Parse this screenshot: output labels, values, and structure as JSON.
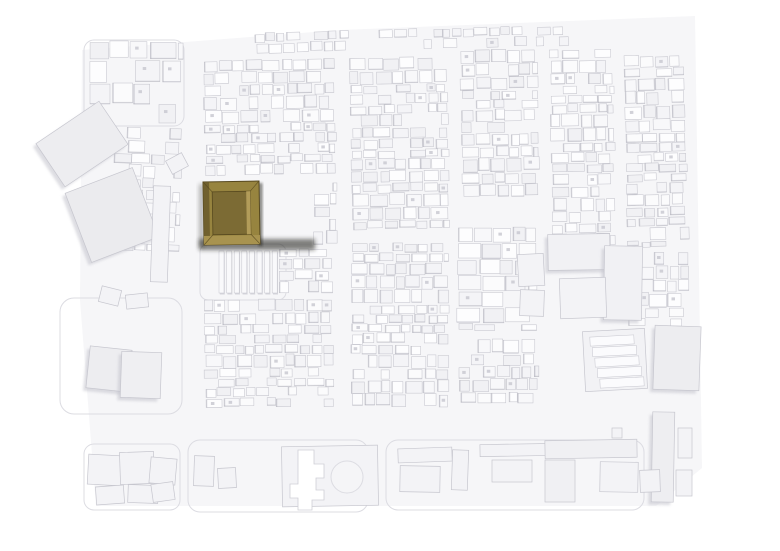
{
  "image": {
    "kind": "photograph of physical architectural massing model",
    "description": "Aerial view of a white urban site model; two brown wooden courtyard buildings are highlighted left of center, all other buildings are white."
  },
  "palette": {
    "bg": "#ffffff",
    "ground": "#f6f6f8",
    "shades": [
      "#fdfdfe",
      "#fbfbfc",
      "#f8f8fa",
      "#f4f4f7",
      "#f1f1f4"
    ],
    "cell_stroke": "#c6c6ce",
    "cell_shadow": "#b2b2bc",
    "hole": "#c9c9d1",
    "big_fill": "#f3f3f6",
    "big_shadow": "#c3c3cc",
    "outline": "#dcdce2",
    "wood_ring": "#97843f",
    "wood_ring_east": "#93803f",
    "wood_edge": "#57491f",
    "wood_left_wall": "#6b5c2c",
    "wood_bottom_band": "#a8934f",
    "wood_court_floor": "#7c6b34",
    "wood_inner_light": "#b29c59",
    "wood_cube": "#c8b171",
    "wood_cube_top": "#d5c182",
    "wood_cube_edge": "#9d874a",
    "court_white": "#d9d9db",
    "court_rim": "#3f361a",
    "opening_black": "#17140c",
    "drop_shadow": "#1f1d15"
  },
  "scene": {
    "ground": {
      "points": "82,50 340,30 695,16 702,468 656,506 96,506 80,300"
    },
    "outlines": [
      {
        "x": 60,
        "y": 298,
        "w": 122,
        "h": 116,
        "r": 14
      },
      {
        "x": 84,
        "y": 40,
        "w": 100,
        "h": 86,
        "r": 10
      },
      {
        "x": 188,
        "y": 440,
        "w": 180,
        "h": 72,
        "r": 12
      },
      {
        "x": 386,
        "y": 440,
        "w": 258,
        "h": 70,
        "r": 12
      },
      {
        "x": 84,
        "y": 444,
        "w": 96,
        "h": 66,
        "r": 10
      },
      {
        "x": 200,
        "y": 244,
        "w": 86,
        "h": 56,
        "r": 8
      }
    ],
    "dense": [
      {
        "x": 205,
        "y": 60,
        "w": 130,
        "h": 114,
        "seed": 11,
        "rot": -1
      },
      {
        "x": 242,
        "y": 30,
        "w": 330,
        "h": 22,
        "seed": 21,
        "rot": -1.5,
        "skip": 0.4,
        "cw": [
          7,
          14
        ],
        "ch": [
          6,
          10
        ]
      },
      {
        "x": 352,
        "y": 58,
        "w": 96,
        "h": 170,
        "seed": 31,
        "rot": -1
      },
      {
        "x": 462,
        "y": 50,
        "w": 76,
        "h": 148,
        "seed": 41,
        "rot": -1
      },
      {
        "x": 552,
        "y": 50,
        "w": 62,
        "h": 194,
        "seed": 51,
        "rot": -1
      },
      {
        "x": 626,
        "y": 56,
        "w": 60,
        "h": 190,
        "seed": 61,
        "rot": -1.5
      },
      {
        "x": 458,
        "y": 228,
        "w": 78,
        "h": 102,
        "seed": 71,
        "cw": [
          12,
          24
        ],
        "ch": [
          9,
          15
        ],
        "hole": 0.2
      },
      {
        "x": 628,
        "y": 252,
        "w": 60,
        "h": 74,
        "seed": 81
      },
      {
        "x": 205,
        "y": 300,
        "w": 128,
        "h": 106,
        "seed": 91,
        "rot": -0.5
      },
      {
        "x": 352,
        "y": 244,
        "w": 96,
        "h": 162,
        "seed": 101
      },
      {
        "x": 460,
        "y": 340,
        "w": 78,
        "h": 62,
        "seed": 111
      },
      {
        "x": 280,
        "y": 250,
        "w": 52,
        "h": 46,
        "seed": 121
      },
      {
        "x": 314,
        "y": 184,
        "w": 22,
        "h": 60,
        "seed": 131,
        "cw": [
          9,
          16
        ]
      },
      {
        "x": 112,
        "y": 128,
        "w": 68,
        "h": 122,
        "seed": 151,
        "skip": 0.4,
        "rot": 2,
        "cw": [
          10,
          18
        ],
        "ch": [
          9,
          15
        ]
      },
      {
        "x": 90,
        "y": 42,
        "w": 92,
        "h": 82,
        "seed": 161,
        "skip": 0.45,
        "cw": [
          16,
          26
        ],
        "ch": [
          14,
          22
        ]
      }
    ],
    "buildings": [
      {
        "x": 44,
        "y": 118,
        "w": 76,
        "h": 52,
        "rot": -34,
        "f": "#ededf0",
        "sh": 1
      },
      {
        "x": 76,
        "y": 178,
        "w": 72,
        "h": 74,
        "rot": -21,
        "f": "#ebebee",
        "sh": 1
      },
      {
        "x": 152,
        "y": 186,
        "w": 17,
        "h": 96,
        "rot": 2
      },
      {
        "x": 168,
        "y": 156,
        "w": 18,
        "h": 15,
        "rot": -28
      },
      {
        "x": 88,
        "y": 348,
        "w": 42,
        "h": 42,
        "rot": 6,
        "f": "#ededf0",
        "sh": 1
      },
      {
        "x": 121,
        "y": 352,
        "w": 40,
        "h": 46,
        "rot": 2,
        "f": "#efeff2",
        "sh": 1
      },
      {
        "x": 100,
        "y": 288,
        "w": 20,
        "h": 16,
        "rot": 14
      },
      {
        "x": 126,
        "y": 294,
        "w": 22,
        "h": 14,
        "rot": -6
      },
      {
        "x": 88,
        "y": 455,
        "w": 34,
        "h": 30,
        "rot": 3
      },
      {
        "x": 120,
        "y": 452,
        "w": 34,
        "h": 32,
        "rot": -2
      },
      {
        "x": 150,
        "y": 458,
        "w": 26,
        "h": 26,
        "rot": 5
      },
      {
        "x": 96,
        "y": 486,
        "w": 28,
        "h": 18,
        "rot": -4
      },
      {
        "x": 128,
        "y": 485,
        "w": 30,
        "h": 18,
        "rot": 2
      },
      {
        "x": 152,
        "y": 483,
        "w": 22,
        "h": 18,
        "rot": -8
      },
      {
        "x": 194,
        "y": 456,
        "w": 20,
        "h": 30,
        "rot": 2
      },
      {
        "x": 218,
        "y": 468,
        "w": 18,
        "h": 20,
        "rot": -3
      },
      {
        "x": 282,
        "y": 446,
        "w": 96,
        "h": 60,
        "rot": -1,
        "f": "#f3f3f6"
      },
      {
        "x": 398,
        "y": 448,
        "w": 54,
        "h": 14,
        "rot": -2
      },
      {
        "x": 400,
        "y": 466,
        "w": 40,
        "h": 26,
        "rot": 1
      },
      {
        "x": 452,
        "y": 450,
        "w": 16,
        "h": 40,
        "rot": 2
      },
      {
        "x": 480,
        "y": 444,
        "w": 76,
        "h": 12,
        "rot": -1
      },
      {
        "x": 492,
        "y": 460,
        "w": 40,
        "h": 22,
        "rot": 0
      },
      {
        "x": 545,
        "y": 440,
        "w": 92,
        "h": 18,
        "rot": -1,
        "f": "#f0f0f3"
      },
      {
        "x": 545,
        "y": 460,
        "w": 30,
        "h": 42,
        "rot": 0,
        "f": "#f0f0f3"
      },
      {
        "x": 600,
        "y": 462,
        "w": 38,
        "h": 30,
        "rot": 1
      },
      {
        "x": 652,
        "y": 412,
        "w": 22,
        "h": 90,
        "rot": 1,
        "f": "#eeeef1",
        "sh": 1
      },
      {
        "x": 678,
        "y": 428,
        "w": 14,
        "h": 30,
        "rot": 0
      },
      {
        "x": 676,
        "y": 470,
        "w": 16,
        "h": 26,
        "rot": 0
      },
      {
        "x": 640,
        "y": 470,
        "w": 20,
        "h": 22,
        "rot": -2
      },
      {
        "x": 612,
        "y": 428,
        "w": 10,
        "h": 10,
        "rot": 0
      },
      {
        "x": 548,
        "y": 234,
        "w": 62,
        "h": 36,
        "rot": -1,
        "f": "#f1f1f4",
        "sh": 1
      },
      {
        "x": 604,
        "y": 246,
        "w": 38,
        "h": 74,
        "rot": 1,
        "f": "#f1f1f4",
        "sh": 1
      },
      {
        "x": 560,
        "y": 278,
        "w": 46,
        "h": 40,
        "rot": -2,
        "f": "#f3f3f6"
      },
      {
        "x": 518,
        "y": 254,
        "w": 26,
        "h": 32,
        "rot": -3
      },
      {
        "x": 520,
        "y": 290,
        "w": 24,
        "h": 26,
        "rot": 2
      },
      {
        "x": 654,
        "y": 326,
        "w": 46,
        "h": 64,
        "rot": 2,
        "f": "#ededf0",
        "sh": 1
      }
    ],
    "slab_rows": {
      "x": 219,
      "y": 251,
      "count": 8,
      "w": 5,
      "gap": 2.6,
      "h": 42
    },
    "steps": {
      "x": 584,
      "y": 330,
      "w": 62,
      "h": 60,
      "rot": -3,
      "count": 5
    },
    "circle": {
      "cx": 347,
      "cy": 477,
      "r": 16
    },
    "cross": {
      "points": "298,450 314,450 314,464 324,464 324,478 316,478 316,490 324,490 324,500 312,500 312,510 298,510 298,498 290,498 290,484 298,484"
    },
    "highlight": {
      "west": {
        "x": 203,
        "y": 182,
        "w": 56,
        "h": 63,
        "rot": -1,
        "court": {
          "x": 9,
          "y": 10,
          "w": 38,
          "h": 43
        },
        "inner_wall": {
          "x": 43,
          "y": 10,
          "w": 4,
          "h": 43
        },
        "cube": {
          "x": 18,
          "y": 12,
          "w": 29,
          "h": 34,
          "rot": 4
        },
        "openings": [
          [
            20,
            54,
            7,
            4
          ],
          [
            30,
            54,
            5,
            4
          ],
          [
            41,
            52,
            9,
            5
          ]
        ]
      },
      "east": {
        "x": 262,
        "y": 179,
        "w": 49,
        "h": 63,
        "rot": -2,
        "court": {
          "x": 15,
          "y": 16,
          "w": 14,
          "h": 32
        },
        "openings": [
          [
            3,
            6,
            8,
            7
          ],
          [
            19,
            2,
            9,
            7
          ],
          [
            34,
            14,
            8,
            8
          ],
          [
            6,
            36,
            8,
            7
          ],
          [
            33,
            38,
            8,
            7
          ],
          [
            10,
            53,
            8,
            6
          ],
          [
            29,
            53,
            8,
            6
          ]
        ]
      }
    },
    "fades": [
      {
        "x": 0,
        "y": 0,
        "w": 780,
        "h": 44,
        "g": "gTop"
      },
      {
        "x": 0,
        "y": 502,
        "w": 780,
        "h": 49,
        "g": "gBottom"
      },
      {
        "x": 0,
        "y": 0,
        "w": 40,
        "h": 551,
        "g": "gLeft"
      },
      {
        "x": 640,
        "y": 0,
        "w": 140,
        "h": 551,
        "g": "gRight"
      }
    ]
  }
}
